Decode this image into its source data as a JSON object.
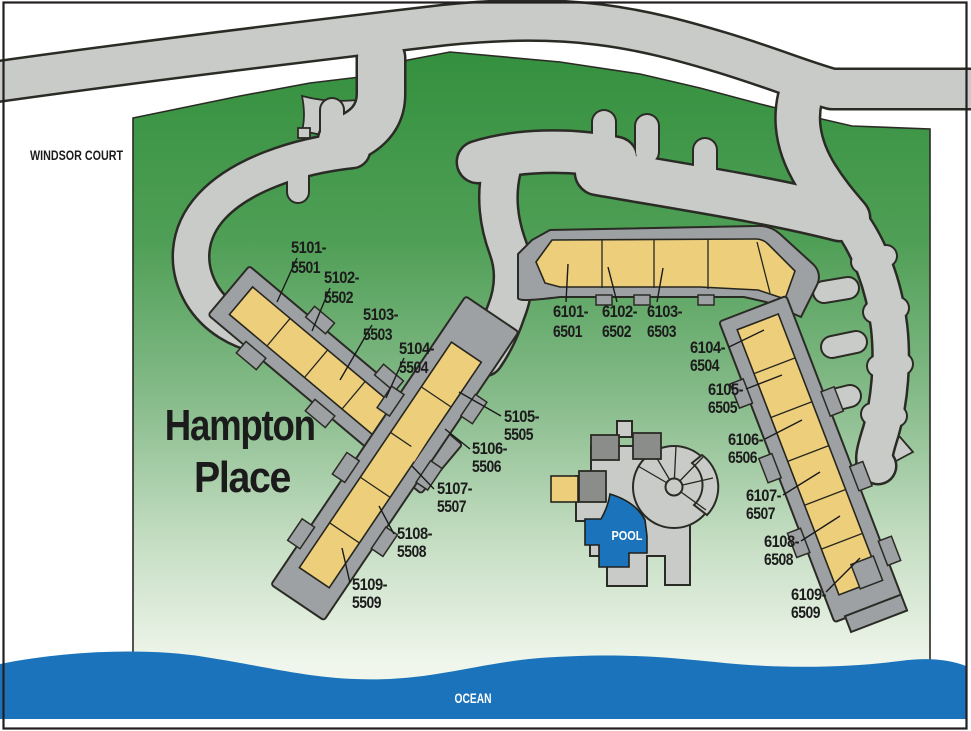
{
  "map": {
    "street_label": "WINDSOR COURT",
    "site_title_line1": "Hampton",
    "site_title_line2": "Place",
    "pool_label": "POOL",
    "ocean_label": "OCEAN"
  },
  "colors": {
    "grass_dark": "#35913F",
    "grass_light": "#F0F6EC",
    "road": "#C9CBC8",
    "outline": "#2B2B25",
    "building_trim": "#9EA1A4",
    "building_fill": "#ECCE7B",
    "roof_dark": "#8A8D8A",
    "water": "#1B74BB",
    "label_text": "#1C1C1C"
  },
  "buildings": {
    "west": {
      "id": "5101-5504",
      "units": [
        {
          "l1": "5101-",
          "l2": "5501"
        },
        {
          "l1": "5102-",
          "l2": "5502"
        },
        {
          "l1": "5103-",
          "l2": "5503"
        },
        {
          "l1": "5104-",
          "l2": "5504"
        }
      ]
    },
    "southwest": {
      "id": "5105-5509",
      "units": [
        {
          "l1": "5105-",
          "l2": "5505"
        },
        {
          "l1": "5106-",
          "l2": "5506"
        },
        {
          "l1": "5107-",
          "l2": "5507"
        },
        {
          "l1": "5108-",
          "l2": "5508"
        },
        {
          "l1": "5109-",
          "l2": "5509"
        }
      ]
    },
    "north": {
      "id": "6101-6503",
      "units": [
        {
          "l1": "6101-",
          "l2": "6501"
        },
        {
          "l1": "6102-",
          "l2": "6502"
        },
        {
          "l1": "6103-",
          "l2": "6503"
        }
      ]
    },
    "east": {
      "id": "6104-6509",
      "units": [
        {
          "l1": "6104-",
          "l2": "6504"
        },
        {
          "l1": "6105-",
          "l2": "6505"
        },
        {
          "l1": "6106-",
          "l2": "6506"
        },
        {
          "l1": "6107-",
          "l2": "6507"
        },
        {
          "l1": "6108-",
          "l2": "6508"
        },
        {
          "l1": "6109-",
          "l2": "6509"
        }
      ]
    }
  }
}
